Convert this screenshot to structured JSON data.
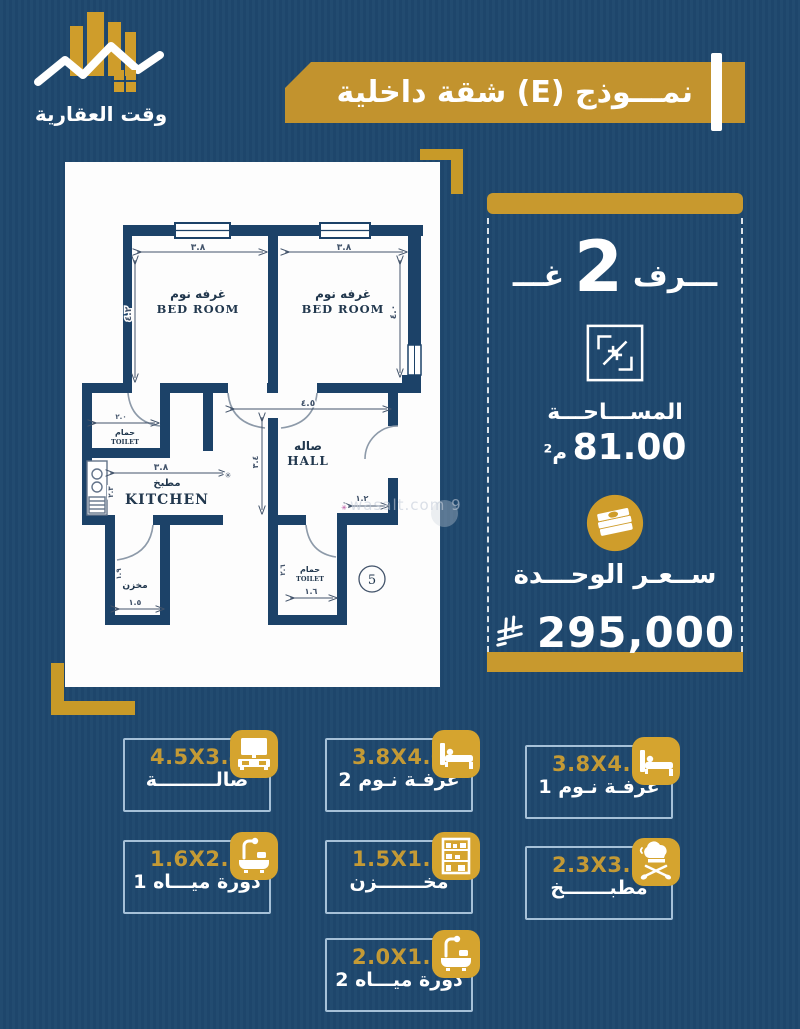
{
  "colors": {
    "background": "#1f486e",
    "gold_banner": "#c2932e",
    "gold_bar": "#c8992e",
    "gold_icon": "#d5a42f",
    "gold_corner": "#c89a28",
    "wall_navy": "#1c4268",
    "card_border": "#a6c1d8",
    "dim_text_gold": "#c49a35",
    "white": "#ffffff"
  },
  "logo": {
    "title": "وقت العقارية"
  },
  "header": {
    "title": "نمـــوذج (E) شقة داخلية"
  },
  "panel": {
    "rooms_prefix": "غـــ",
    "rooms_count": "2",
    "rooms_suffix": "ـــرف",
    "area_label": "المســـاحـــة",
    "area_value": "81.00",
    "area_unit": "م²",
    "price_label": "ســعـر الوحـــدة",
    "price_value": "295,000",
    "currency_icon": "saudi-riyal-symbol"
  },
  "plan": {
    "bedroom_ar": "غرفه نوم",
    "bedroom_en": "BED ROOM",
    "hall_ar": "صاله",
    "hall_en": "HALL",
    "kitchen_ar": "مطبخ",
    "kitchen_en": "KITCHEN",
    "toilet_ar": "حمام",
    "toilet_en": "TOILET",
    "storage_ar": "مخزن",
    "unit_number": "5",
    "dims": {
      "bed_left_w": "٣.٨",
      "bed_right_w": "٣.٨",
      "bed_left_h": "٤.٢",
      "bed_right_h": "٤.٠",
      "hall_w": "٤.٥",
      "hall_h": "٣.٤",
      "kitchen_w": "٣.٨",
      "kitchen_h": "٢.٣",
      "toilet1_w": "٢.٠",
      "storage_w": "١.٥",
      "storage_h": "١.٩",
      "toilet2_w": "١.٦",
      "toilet2_h": "٢.٦",
      "entry_w": "١.٢"
    }
  },
  "watermark": "wasalt.com 9",
  "cards": [
    {
      "dim": "4.5X3.4",
      "name": "صالـــــــــة",
      "icon": "sofa-tv"
    },
    {
      "dim": "3.8X4.0",
      "name": "غرفـة نـوم 2",
      "icon": "bed"
    },
    {
      "dim": "3.8X4.2",
      "name": "غرفـة نـوم 1",
      "icon": "bed"
    },
    {
      "dim": "1.6X2.6",
      "name": "دورة ميـــاه 1",
      "icon": "bath"
    },
    {
      "dim": "1.5X1.9",
      "name": "مخـــــــزن",
      "icon": "shelf"
    },
    {
      "dim": "2.3X3.8",
      "name": "مطبـــــــخ",
      "icon": "kitchen"
    },
    {
      "dim": "2.0X1.5",
      "name": "دورة ميـــاه 2",
      "icon": "bath"
    }
  ]
}
